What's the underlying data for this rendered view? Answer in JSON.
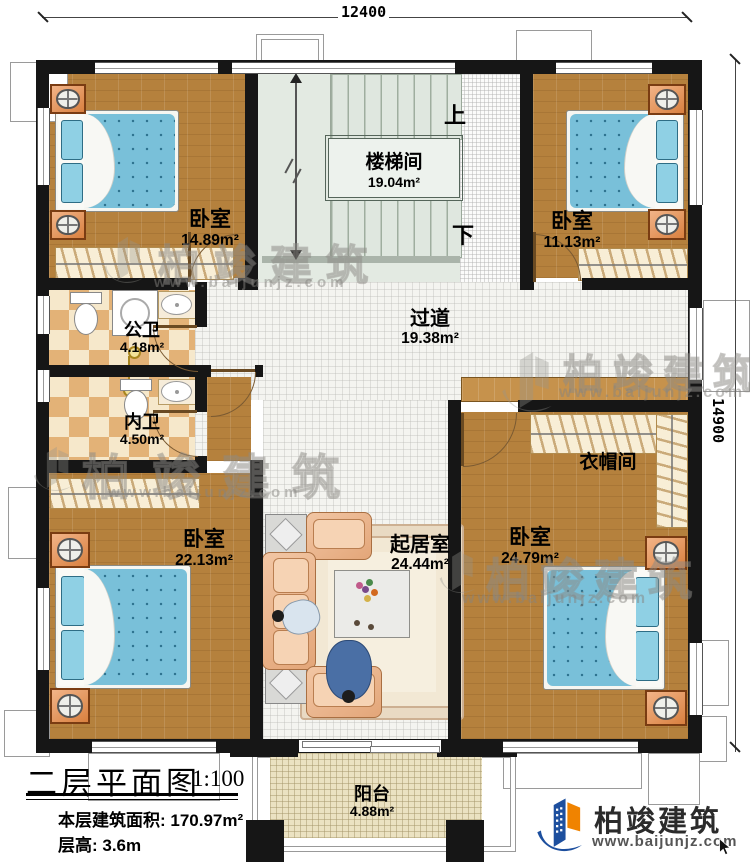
{
  "dimensions": {
    "width_mm": "12400",
    "height_mm": "14900"
  },
  "rooms": {
    "bedroom_tl": {
      "name": "卧室",
      "area": "14.89m²"
    },
    "stairwell": {
      "name": "楼梯间",
      "area": "19.04m²"
    },
    "bedroom_tr": {
      "name": "卧室",
      "area": "11.13m²"
    },
    "public_bath": {
      "name": "公卫",
      "area": "4.18m²"
    },
    "ensuite_bath": {
      "name": "内卫",
      "area": "4.50m²"
    },
    "corridor": {
      "name": "过道",
      "area": "19.38m²"
    },
    "cloakroom": {
      "name": "衣帽间"
    },
    "bedroom_bl": {
      "name": "卧室",
      "area": "22.13m²"
    },
    "living_room": {
      "name": "起居室",
      "area": "24.44m²"
    },
    "bedroom_br": {
      "name": "卧室",
      "area": "24.79m²"
    },
    "balcony": {
      "name": "阳台",
      "area": "4.88m²"
    }
  },
  "stairs": {
    "up_label": "上",
    "down_label": "下"
  },
  "title_block": {
    "title": "二层平面图",
    "scale": "1:100",
    "floor_area": "本层建筑面积: 170.97m²",
    "floor_height": "层高: 3.6m"
  },
  "brand": {
    "name": "柏竣建筑",
    "website": "www.baijunjz.com"
  },
  "watermark": {
    "name": "柏竣建筑",
    "website": "www.baijunjz.com"
  }
}
